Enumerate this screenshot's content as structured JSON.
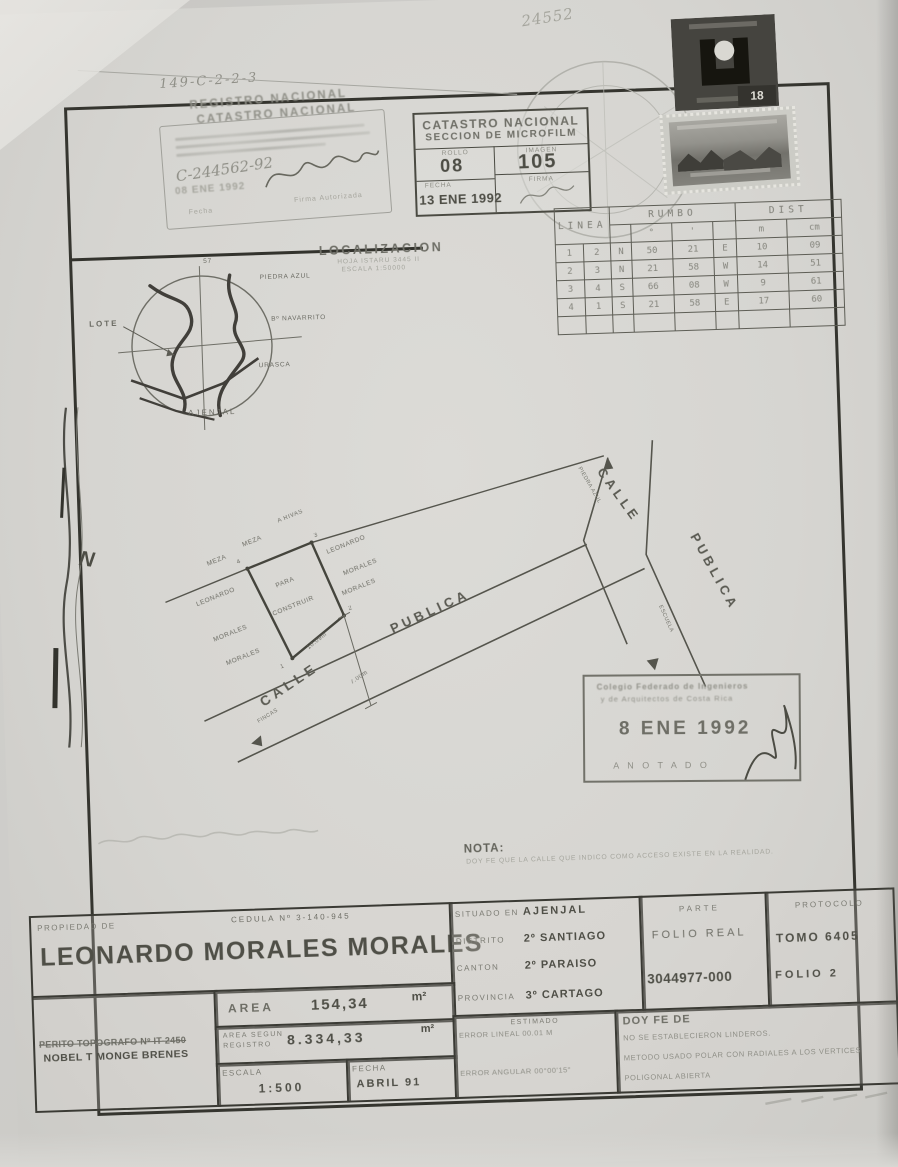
{
  "page": {
    "handwritten_code": "149-C-2-2-3",
    "handwritten_number": "24552",
    "north_letter": "N"
  },
  "registro_stamp": {
    "line1": "REGISTRO NACIONAL",
    "line2": "CATASTRO NACIONAL",
    "handwritten_ref": "C-244562-92",
    "date_stamp": "08 ENE 1992",
    "fecha_label": "Fecha",
    "firma_label": "Firma Autorizada"
  },
  "microfilm_box": {
    "title1": "CATASTRO NACIONAL",
    "title2": "SECCION DE MICROFILM",
    "rollo_label": "ROLLO",
    "rollo_value": "08",
    "imagen_label": "IMAGEN",
    "imagen_value": "105",
    "fecha_label": "FECHA",
    "fecha_value": "13 ENE 1992",
    "firma_label": "FIRMA"
  },
  "revenue_stamp": {
    "value": "18"
  },
  "survey_table": {
    "linea_header": "LINEA",
    "rumbo_header": "RUMBO",
    "dist_header": "DIST",
    "deg": "°",
    "min": "'",
    "m": "m",
    "cm": "cm",
    "rows": [
      [
        "1",
        "2",
        "N",
        "50",
        "21",
        "E",
        "10",
        "09"
      ],
      [
        "2",
        "3",
        "N",
        "21",
        "58",
        "W",
        "14",
        "51"
      ],
      [
        "3",
        "4",
        "S",
        "66",
        "08",
        "W",
        "9",
        "61"
      ],
      [
        "4",
        "1",
        "S",
        "21",
        "58",
        "E",
        "17",
        "60"
      ]
    ]
  },
  "localizacion": {
    "title": "LOCALIZACION",
    "sub1": "HOJA ISTARU 3445 II",
    "sub2": "ESCALA 1:50000",
    "north_tick": "57",
    "lote": "LOTE",
    "piedra_azul": "PIEDRA AZUL",
    "navarrito": "Bº NAVARRITO",
    "urasca": "URASCA",
    "ajenjal": "AJENJAL"
  },
  "plot": {
    "a_rivas": "A RIVAS",
    "meza_a": "MEZA",
    "meza_b": "MEZA",
    "owner_left_1": "LEONARDO",
    "owner_left_2": "MORALES",
    "owner_left_3": "MORALES",
    "inner_1": "PARA",
    "inner_2": "CONSTRUIR",
    "owner_right_1": "LEONARDO",
    "owner_right_2": "MORALES",
    "owner_right_3": "MORALES",
    "v1": "1",
    "v2": "2",
    "v3": "3",
    "v4": "4",
    "dim_bottom": "10.09m",
    "dim_front": "7.00m",
    "calle_1": "CALLE",
    "publica_1": "PUBLICA",
    "piedra_azul_dir": "PIEDRA AZUL",
    "escuela_dir": "ESCUELA",
    "calle_2": "CALLE",
    "publica_2": "PUBLICA",
    "fincas_dir": "FINCAS"
  },
  "colegio_stamp": {
    "line1": "Colegio Federado de Ingenieros",
    "line2": "y de Arquitectos de Costa Rica",
    "date": "8 ENE 1992",
    "anotado": "A N O T A D O"
  },
  "nota": {
    "title": "NOTA:",
    "body": "DOY FE QUE LA CALLE QUE INDICO COMO ACCESO EXISTE EN LA REALIDAD."
  },
  "info": {
    "propiedad_label": "PROPIEDAD DE",
    "cedula": "CEDULA Nº 3-140-945",
    "owner_name": "LEONARDO MORALES MORALES",
    "situado_label": "SITUADO EN",
    "situado_value": "AJENJAL",
    "distrito_label": "DISTRITO",
    "distrito_value": "2º SANTIAGO",
    "canton_label": "CANTON",
    "canton_value": "2º PARAISO",
    "provincia_label": "PROVINCIA",
    "provincia_value": "3º CARTAGO",
    "parte_label": "PARTE",
    "folio_real_label": "FOLIO REAL",
    "folio_real_value": "3044977-000",
    "protocolo_label": "PROTOCOLO",
    "tomo": "TOMO 6405",
    "folio": "FOLIO 2",
    "area_label": "AREA",
    "area_value": "154,34",
    "area_unit": "m²",
    "area_registro_label1": "AREA SEGUN",
    "area_registro_label2": "REGISTRO",
    "area_registro_value": "8.334,33",
    "area_registro_unit": "m²",
    "escala_label": "ESCALA",
    "escala_value": "1:500",
    "fecha_label": "FECHA",
    "fecha_value": "ABRIL 91",
    "perito_label": "PERITO TOPOGRAFO Nº IT-2450",
    "perito_name": "NOBEL T MONGE BRENES",
    "estimado_label": "ESTIMADO",
    "error_lineal": "ERROR LINEAL  00.01  M",
    "error_angular": "ERROR ANGULAR 00°00'15\"",
    "doyfe_title": "DOY FE DE",
    "doyfe_1": "NO SE ESTABLECIERON LINDEROS.",
    "doyfe_2": "METODO USADO POLAR CON RADIALES A LOS VERTICES",
    "doyfe_3": "POLIGONAL ABIERTA"
  }
}
